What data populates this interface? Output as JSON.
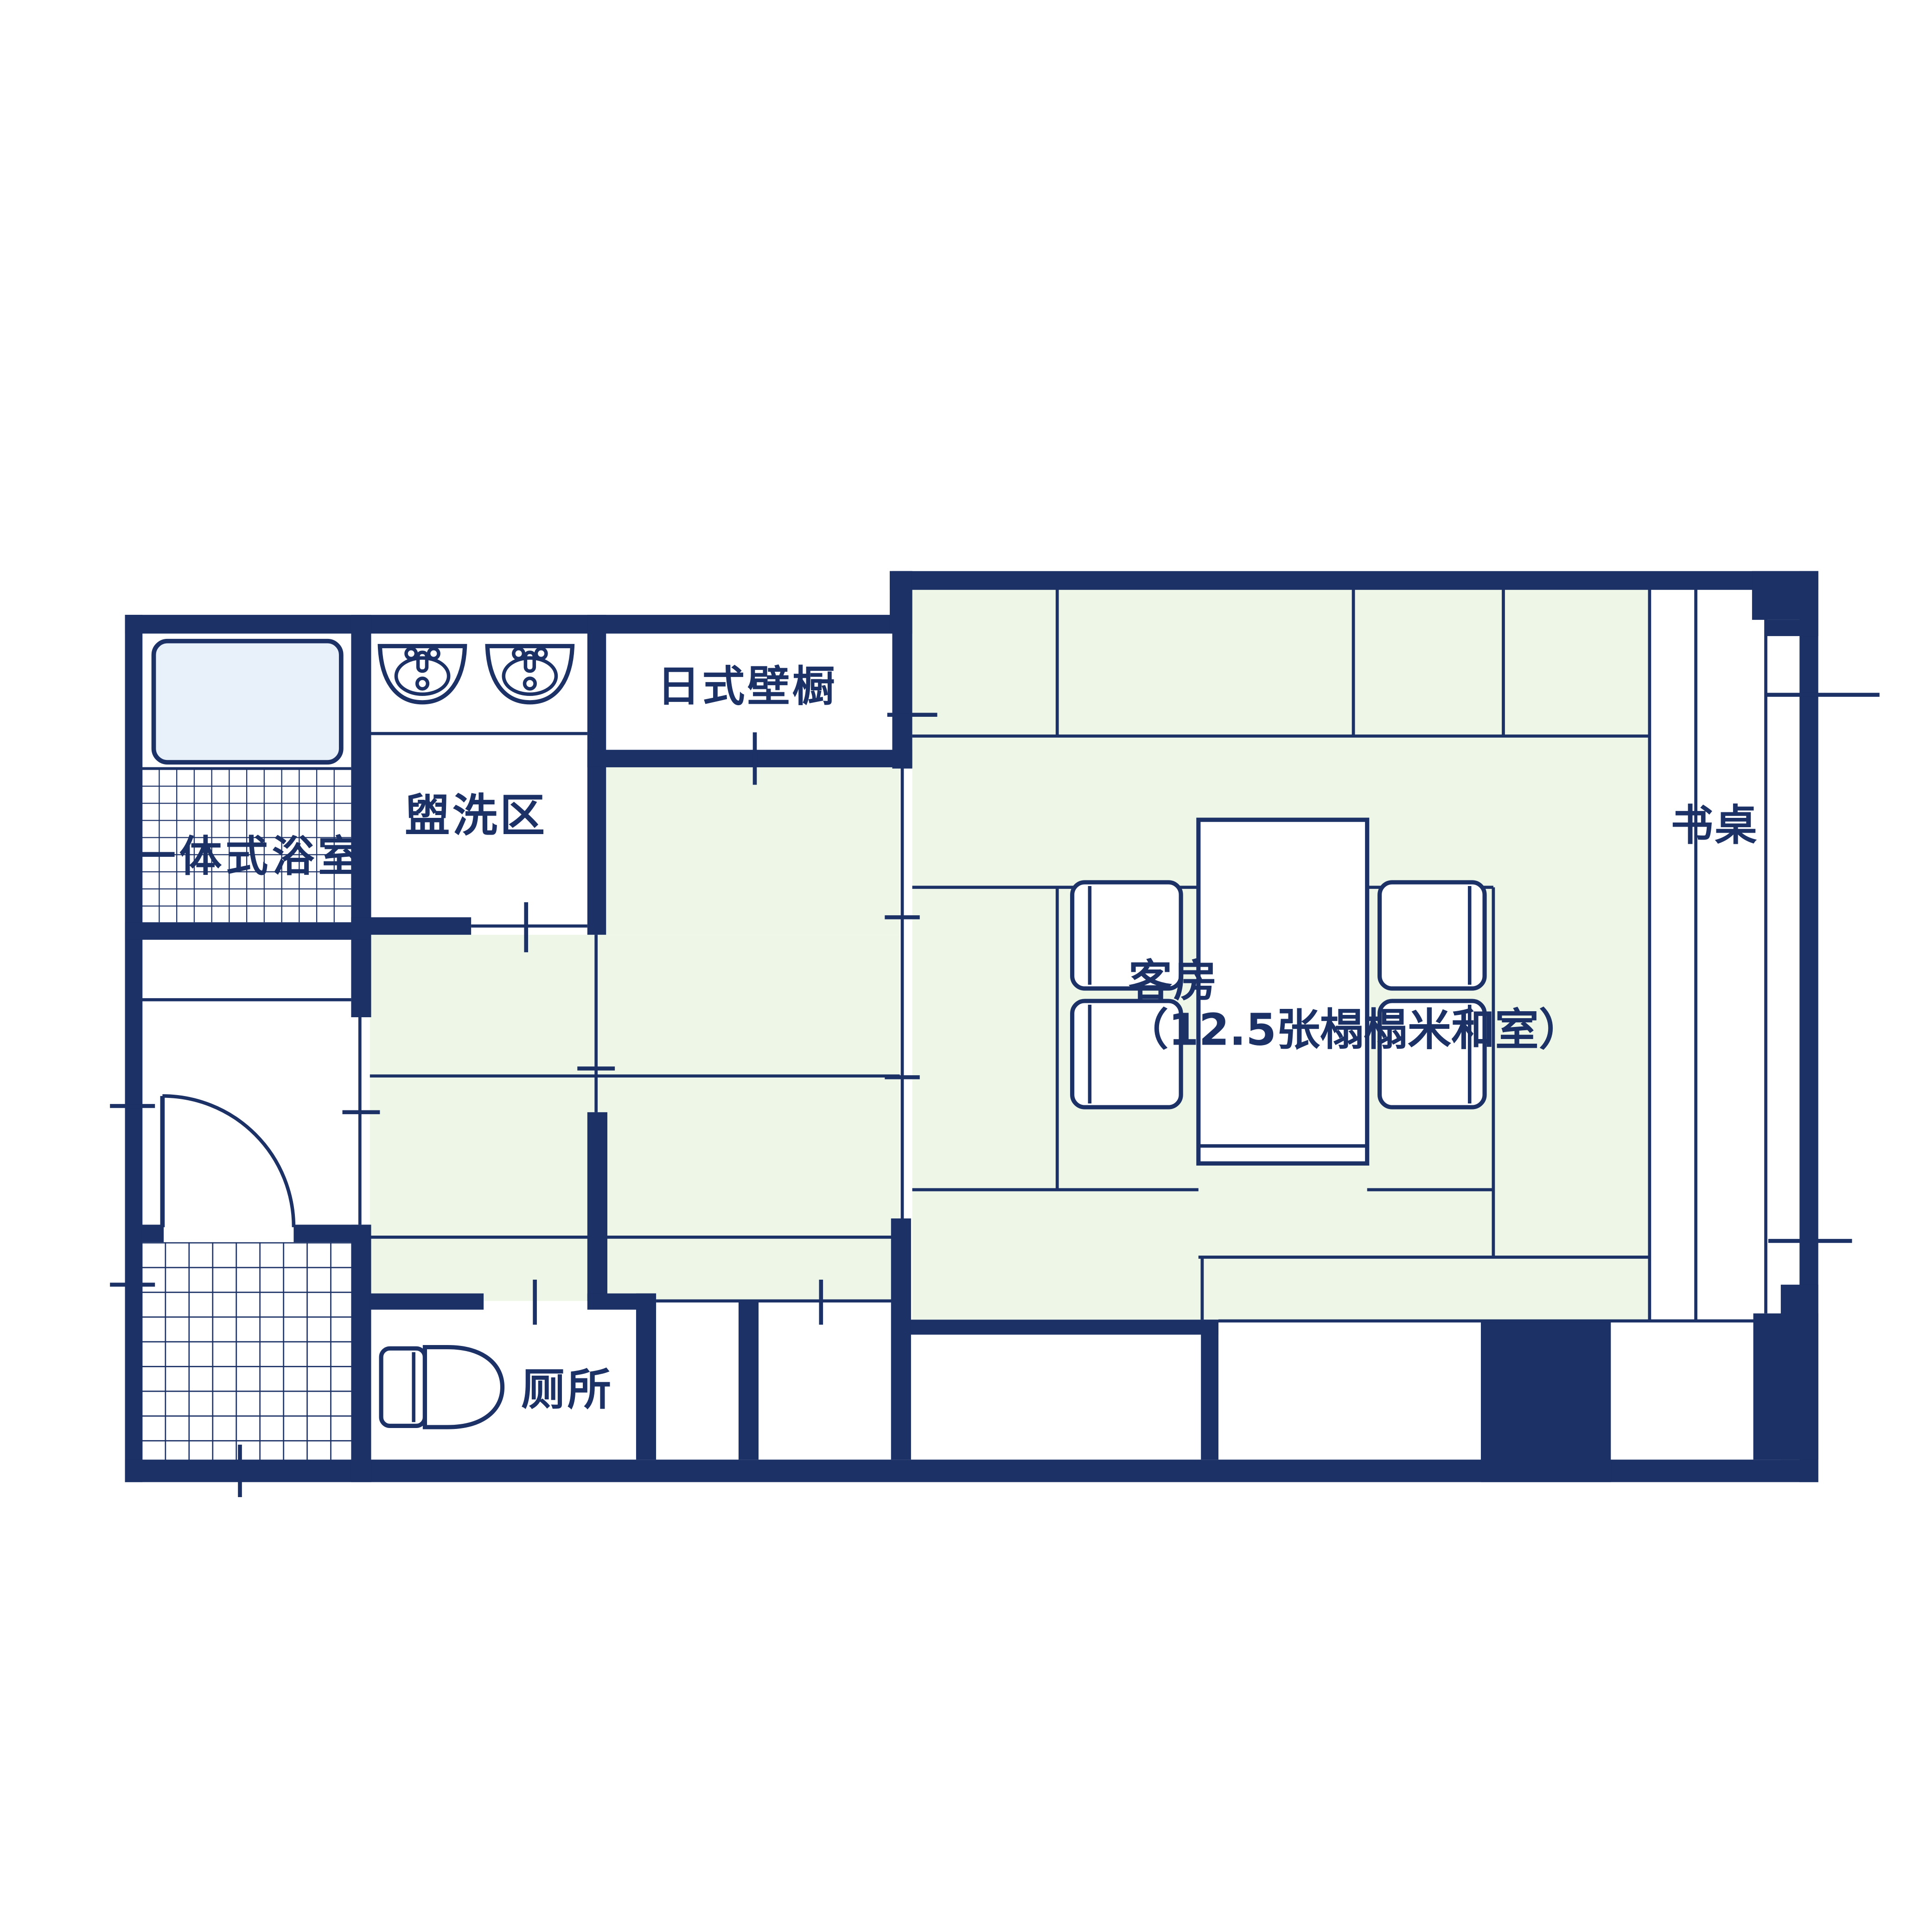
{
  "plan": {
    "rooms": {
      "unit_bathroom": {
        "label": "一体式浴室"
      },
      "washing_area": {
        "label": "盥洗区"
      },
      "japanese_closet": {
        "label": "日式壁橱"
      },
      "guest_room": {
        "label": "客房",
        "detail": "（12.5张榻榻米和室）"
      },
      "desk": {
        "label": "书桌"
      },
      "toilet": {
        "label": "厕所"
      }
    },
    "colors": {
      "wall": "#1c3166",
      "tatami": "#eef7e7",
      "bathtub": "#e8f1fa",
      "background": "#ffffff"
    }
  }
}
